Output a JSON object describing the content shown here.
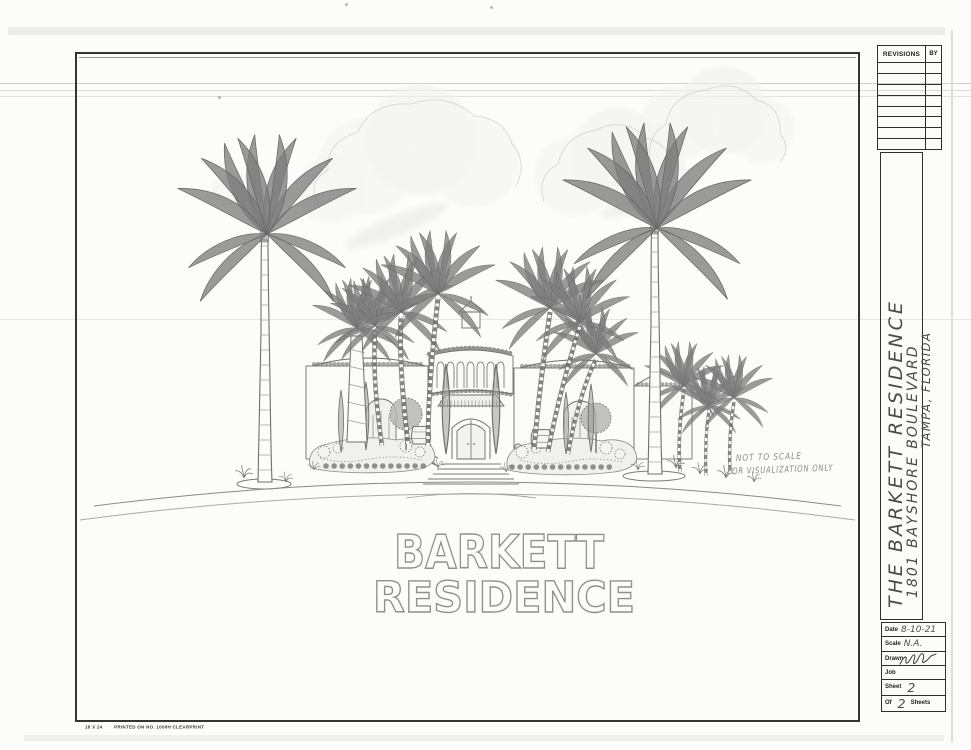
{
  "sheet": {
    "revisions_table": {
      "col1_header": "REVISIONS",
      "col2_header": "BY",
      "empty_rows": 8
    },
    "project_block": {
      "line1": "THE BARKETT RESIDENCE",
      "line2": "1801 BAYSHORE BOULEVARD",
      "line3": "TAMPA, FLORIDA"
    },
    "info_table": {
      "rows": [
        {
          "label": "Date",
          "value": "8-10-21"
        },
        {
          "label": "Scale",
          "value": "N.A."
        },
        {
          "label": "Drawn",
          "value": ""
        },
        {
          "label": "Job",
          "value": ""
        },
        {
          "label": "Sheet",
          "value": "2"
        }
      ],
      "of_row": {
        "label": "Of",
        "value": "2",
        "suffix": "Sheets"
      }
    },
    "drawing": {
      "title_line1": "BARKETT",
      "title_line2": "RESIDENCE",
      "note_line1": "NOT TO SCALE",
      "note_line2": "FOR VISUALIZATION ONLY"
    },
    "footer_print": {
      "size": "18 X 24",
      "text": "PRINTED ON NO. 1000H CLEARPRINT"
    }
  },
  "colors": {
    "paper": "#fcfcfa",
    "border_ink": "#2f2f2f",
    "pencil": "#6f6f6f",
    "handwriting": "#4a4a4a"
  }
}
